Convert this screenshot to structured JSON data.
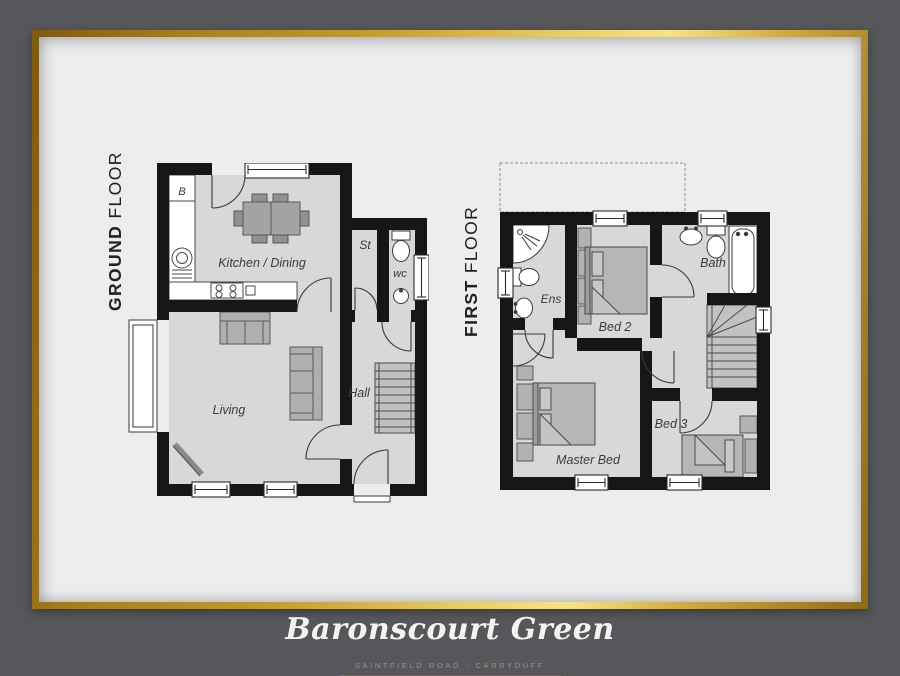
{
  "poster": {
    "colors": {
      "background": "#56575a",
      "panel": "#ededee",
      "wall": "#161616",
      "room_fill": "#d8d8da",
      "furniture": "#b4b6b8",
      "gold_frame": "#d2ab45"
    },
    "ground_floor": {
      "title_primary": "GROUND",
      "title_secondary": "FLOOR",
      "labels": {
        "boiler": "B",
        "kitchen_dining": "Kitchen / Dining",
        "store": "St",
        "wc": "wc",
        "hall": "Hall",
        "living": "Living"
      }
    },
    "first_floor": {
      "title_primary": "FIRST",
      "title_secondary": "FLOOR",
      "labels": {
        "ensuite": "Ens",
        "bed2": "Bed 2",
        "bath": "Bath",
        "master_bed": "Master Bed",
        "bed3": "Bed 3"
      }
    },
    "footer": {
      "title": "Baronscourt Green",
      "subtitle": "SAINTFIELD ROAD - CARRYDUFF"
    }
  }
}
